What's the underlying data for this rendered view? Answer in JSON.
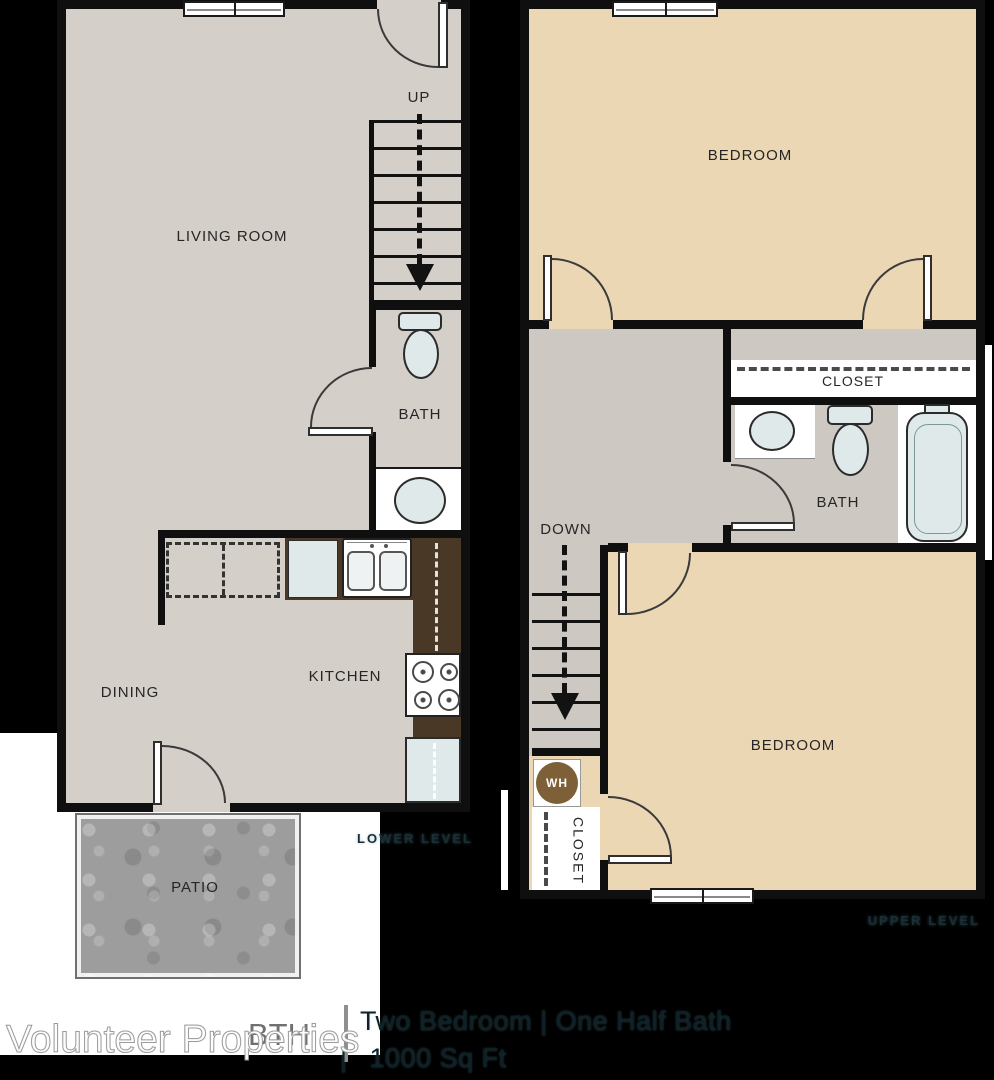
{
  "footer": {
    "brand": "Volunteer Properties",
    "plan_code": "BTH",
    "divider": "|",
    "unit_title": "Two Bedroom  |  One Half Bath",
    "sqft": "1000 Sq Ft"
  },
  "lower_level": {
    "label": "LOWER LEVEL",
    "living_room": "LIVING ROOM",
    "bath": "BATH",
    "kitchen": "KITCHEN",
    "dining": "DINING",
    "patio": "PATIO",
    "up": "UP"
  },
  "upper_level": {
    "label": "UPPER LEVEL",
    "bedroom_top": "BEDROOM",
    "bedroom_bottom": "BEDROOM",
    "closet_hall": "CLOSET",
    "closet_bedroom": "CLOSET",
    "bath": "BATH",
    "down": "DOWN",
    "water_heater": "WH"
  },
  "colors": {
    "floor_gray": "#d4cfc8",
    "floor_tan": "#ebd7b4",
    "hall_gray": "#cdc8c1",
    "counter_brown": "#4a3826",
    "fixture_blue": "#dfe9ea",
    "patio_gray": "#9d9d9d",
    "wall": "#0f0f0f"
  }
}
